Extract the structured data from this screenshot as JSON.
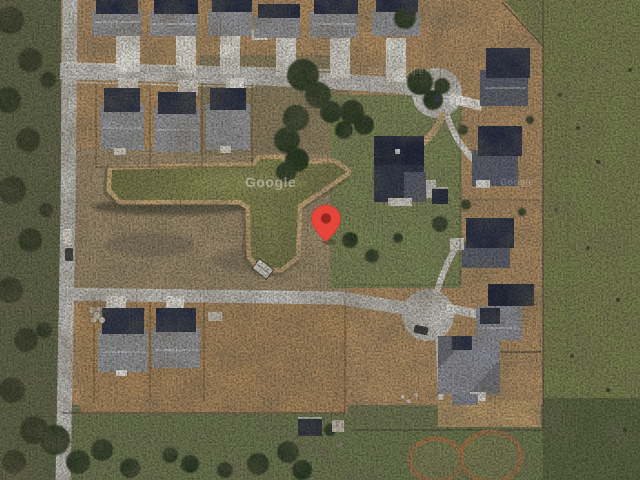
{
  "map": {
    "view_type": "satellite-imagery",
    "watermarks": [
      {
        "id": "pond-tile",
        "text": "Google"
      },
      {
        "id": "right-tile",
        "text": "Google"
      },
      {
        "id": "road-tile",
        "text": "2022 Google"
      }
    ],
    "pin": {
      "icon": "location-pin-icon",
      "fill": "#E8453A",
      "inner": "#8E2620"
    },
    "colors": {
      "road": "#C6C4BF",
      "concrete": "#E7E5DE",
      "pond_water_dark": "#6F7243",
      "pond_water_light": "#8B8E55",
      "pond_bank": "#C9AA7B",
      "field_green": "#79814F",
      "field_dark": "#57633F",
      "pasture": "#6D7850",
      "dirt_tan": "#B29066",
      "scrub": "#9F8D6F",
      "tree_green": "#2F3D27",
      "roof_navy": "#2A3145",
      "roof_gray": "#97989C",
      "left_scrub": "#5E6547"
    }
  }
}
